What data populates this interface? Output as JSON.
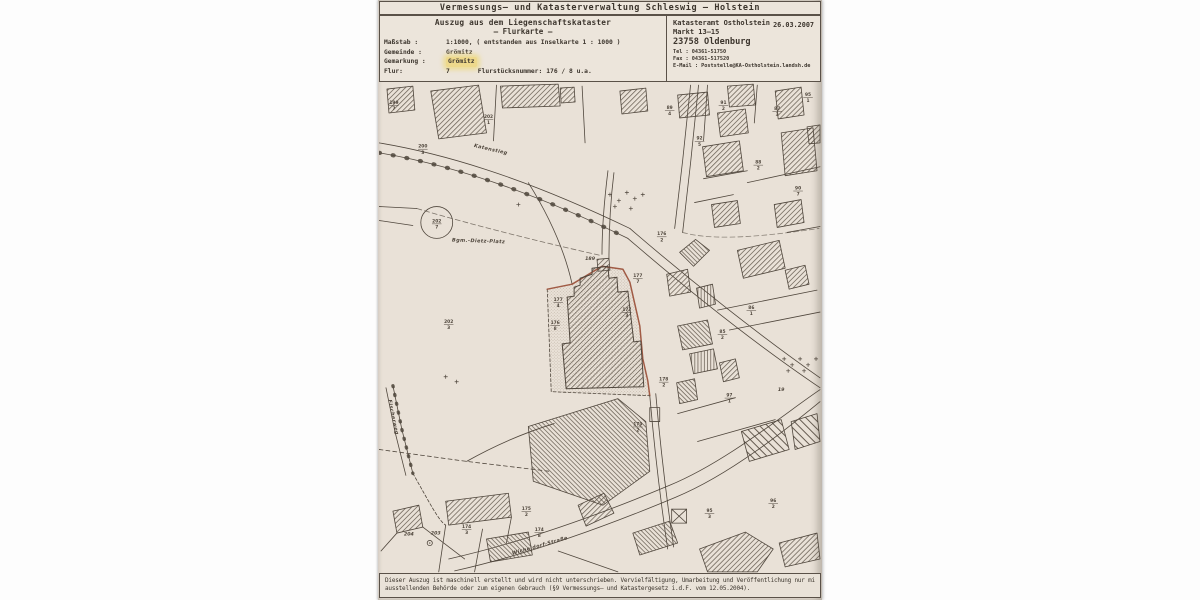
{
  "document": {
    "title": "Vermessungs– und Katasterverwaltung Schleswig – Holstein",
    "excerpt": {
      "heading": "Auszug aus dem Liegenschaftskataster",
      "subheading": "– Flurkarte –",
      "fields": [
        {
          "label": "Maßstab :",
          "value": "1:1000, ( entstanden aus Inselkarte 1 : 1000 )"
        },
        {
          "label": "Gemeinde :",
          "value": "Grömitz"
        },
        {
          "label": "Gemarkung :",
          "value": "Grömitz"
        },
        {
          "label": "Flur:",
          "value": "7",
          "extra_label": "Flurstücksnummer:",
          "extra_value": "176 / 8 u.a."
        }
      ]
    },
    "office": {
      "name": "Katasteramt Ostholstein",
      "street": "Markt 13–15",
      "city": "23758 Oldenburg",
      "tel": "Tel : 04361-51750",
      "fax": "Fax : 04361-517520",
      "email": "E-Mail : Poststelle@KA-Ostholstein.landsh.de",
      "date": "26.03.2007"
    },
    "footer": {
      "line1": "Dieser Auszug ist maschinell erstellt und wird nicht unterschrieben. Vervielfältigung, Umarbeitung und Veröffentlichung nur mit Zustimmung der",
      "line2": "ausstellenden Behörde oder zum eigenen Gebrauch (§9 Vermessungs– und Katastergesetz i.d.F. vom 12.05.2004)."
    }
  },
  "map": {
    "colors": {
      "paper": "#e9e1d7",
      "ink": "#4f463c",
      "subject_outline": "#9a4f38",
      "highlight_yellow": "#eed98c"
    },
    "street_labels": [
      {
        "text": "Katenstieg",
        "x": 112,
        "y": 68,
        "rot": 13
      },
      {
        "text": "Bgm.-Dietz-Platz",
        "x": 100,
        "y": 160,
        "rot": 2
      },
      {
        "text": "Fischerweg",
        "x": 13,
        "y": 336,
        "rot": 78
      },
      {
        "text": "Wicheldorf-Straße",
        "x": 162,
        "y": 466,
        "rot": -16
      }
    ],
    "parcel_labels": [
      {
        "num": "199",
        "den": "7",
        "x": 15,
        "y": 22
      },
      {
        "num": "202",
        "den": "1",
        "x": 110,
        "y": 36
      },
      {
        "num": "200",
        "den": "3",
        "x": 44,
        "y": 66
      },
      {
        "num": "202",
        "den": "7",
        "x": 58,
        "y": 141
      },
      {
        "num": "202",
        "den": "3",
        "x": 70,
        "y": 242
      },
      {
        "num": "89",
        "den": "4",
        "x": 292,
        "y": 27
      },
      {
        "num": "91",
        "den": "2",
        "x": 346,
        "y": 22
      },
      {
        "num": "87",
        "den": "3",
        "x": 400,
        "y": 28
      },
      {
        "num": "95",
        "den": "1",
        "x": 431,
        "y": 14
      },
      {
        "num": "92",
        "den": "5",
        "x": 322,
        "y": 58
      },
      {
        "num": "88",
        "den": "2",
        "x": 381,
        "y": 82
      },
      {
        "num": "90",
        "den": "7",
        "x": 421,
        "y": 108
      },
      {
        "num": "189",
        "x": 212,
        "y": 176
      },
      {
        "num": "177",
        "den": "4",
        "x": 180,
        "y": 220
      },
      {
        "num": "177",
        "den": "7",
        "x": 260,
        "y": 196
      },
      {
        "num": "177",
        "den": "3",
        "x": 249,
        "y": 230
      },
      {
        "num": "176",
        "den": "2",
        "x": 284,
        "y": 154
      },
      {
        "num": "176",
        "den": "8",
        "x": 177,
        "y": 243
      },
      {
        "num": "178",
        "den": "2",
        "x": 286,
        "y": 300
      },
      {
        "num": "179",
        "den": "2",
        "x": 260,
        "y": 345
      },
      {
        "num": "85",
        "den": "2",
        "x": 345,
        "y": 252
      },
      {
        "num": "86",
        "den": "1",
        "x": 374,
        "y": 228
      },
      {
        "num": "204",
        "x": 30,
        "y": 453
      },
      {
        "num": "203",
        "x": 57,
        "y": 452
      },
      {
        "num": "174",
        "den": "3",
        "x": 88,
        "y": 448
      },
      {
        "num": "174",
        "den": "8",
        "x": 161,
        "y": 451
      },
      {
        "num": "175",
        "den": "2",
        "x": 148,
        "y": 430
      },
      {
        "num": "95",
        "den": "3",
        "x": 332,
        "y": 432
      },
      {
        "num": "96",
        "den": "2",
        "x": 396,
        "y": 422
      },
      {
        "num": "97",
        "den": "1",
        "x": 352,
        "y": 316
      },
      {
        "num": "19",
        "x": 404,
        "y": 308
      }
    ],
    "crosses": [
      [
        140,
        122
      ],
      [
        67,
        295
      ],
      [
        78,
        300
      ],
      [
        232,
        112
      ],
      [
        241,
        118
      ],
      [
        249,
        110
      ],
      [
        257,
        116
      ],
      [
        265,
        112
      ],
      [
        237,
        124
      ],
      [
        253,
        126
      ],
      [
        407,
        277
      ],
      [
        415,
        283
      ],
      [
        423,
        277
      ],
      [
        431,
        283
      ],
      [
        439,
        277
      ],
      [
        411,
        289
      ],
      [
        427,
        289
      ]
    ]
  }
}
